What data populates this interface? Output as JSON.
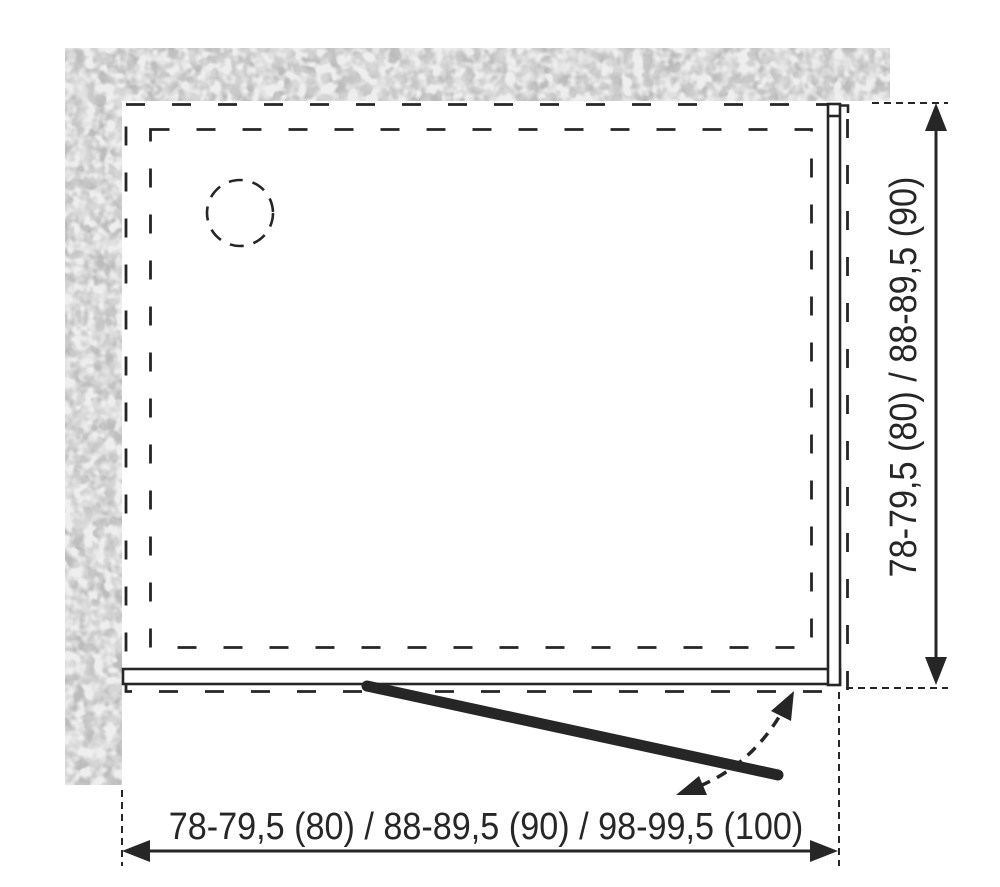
{
  "dimensions": {
    "width": {
      "label": "78-79,5 (80) / 88-89,5 (90) / 98-99,5 (100)"
    },
    "height": {
      "label": "78-79,5 (80) / 88-89,5 (90)"
    }
  },
  "colors": {
    "background": "#ffffff",
    "line": "#262626",
    "wall_fill_base": "#d6d6d6",
    "wall_blotch": "#bcbcbc",
    "wall_speckle": "#eeeeee"
  }
}
